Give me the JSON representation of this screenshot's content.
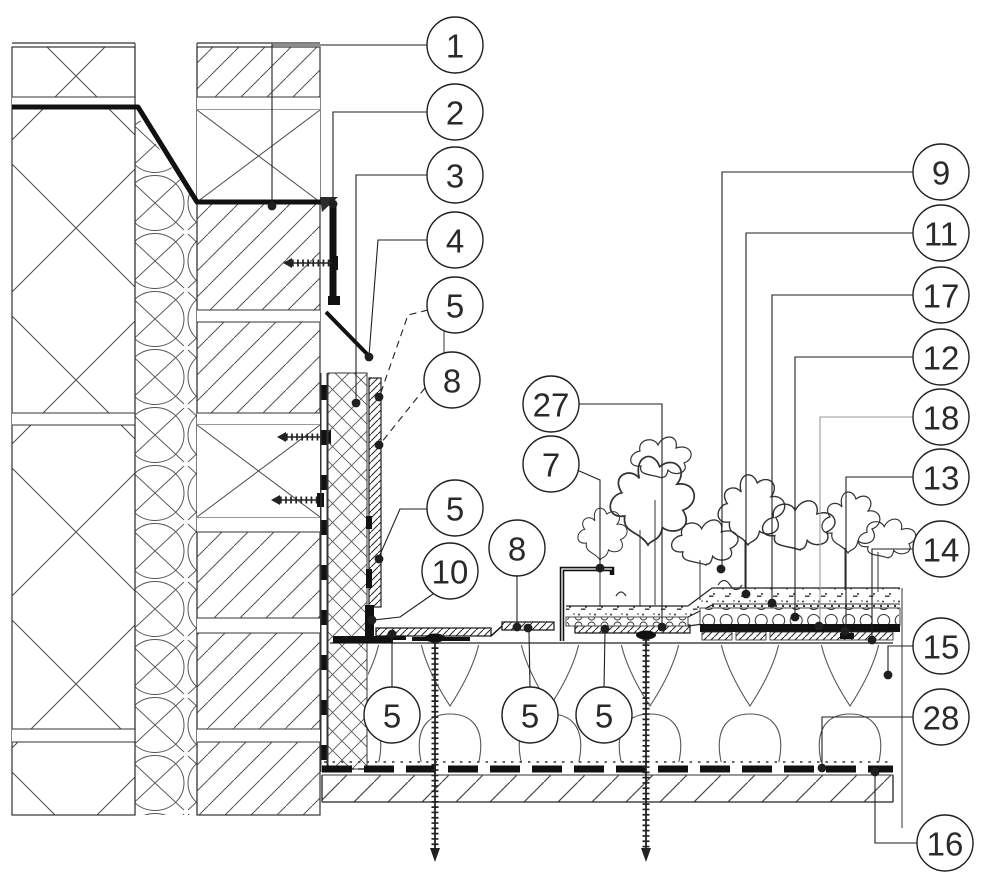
{
  "figure": {
    "type": "architectural-section-detail",
    "description": "Construction detail section: parapet wall junction with extensive green roof build-up, numbered component callouts",
    "colors": {
      "line": "#1f1f1f",
      "gray_leader": "#9a9a9a",
      "background": "#ffffff"
    },
    "callout_style": {
      "radius": 28,
      "font_size": 33,
      "dot_radius": 4.4
    },
    "callouts": [
      {
        "label": "1",
        "cx": 455,
        "cy": 45,
        "leader": [
          [
            427,
            45
          ],
          [
            272,
            45
          ],
          [
            272,
            206
          ]
        ],
        "dot": [
          272,
          206
        ]
      },
      {
        "label": "2",
        "cx": 455,
        "cy": 112,
        "leader": [
          [
            427,
            112
          ],
          [
            333,
            112
          ],
          [
            333,
            203
          ]
        ],
        "dot": [
          333,
          204
        ]
      },
      {
        "label": "3",
        "cx": 455,
        "cy": 175,
        "leader": [
          [
            427,
            175
          ],
          [
            356,
            175
          ],
          [
            356,
            402
          ]
        ],
        "dot": [
          356,
          403
        ]
      },
      {
        "label": "4",
        "cx": 455,
        "cy": 240,
        "leader": [
          [
            427,
            240
          ],
          [
            378,
            240
          ],
          [
            369,
            356
          ]
        ],
        "dot": [
          369,
          357
        ]
      },
      {
        "label": "5",
        "cx": 455,
        "cy": 305,
        "leader": [
          [
            428,
            310
          ],
          [
            408,
            315
          ],
          [
            380,
            395
          ]
        ],
        "dot": [
          379,
          397
        ],
        "dashed": true
      },
      {
        "label": "8",
        "cx": 452,
        "cy": 380,
        "leader": [
          [
            425,
            388
          ],
          [
            381,
            443
          ]
        ],
        "dot": [
          379,
          445
        ],
        "dashed": true
      },
      {
        "label": "5",
        "cx": 455,
        "cy": 508,
        "leader": [
          [
            429,
            509
          ],
          [
            400,
            509
          ],
          [
            379,
            557
          ]
        ],
        "dot": [
          379,
          559
        ]
      },
      {
        "label": "10",
        "cx": 450,
        "cy": 571,
        "leader": [
          [
            433,
            594
          ],
          [
            400,
            617
          ],
          [
            374,
            620
          ]
        ],
        "dot": [
          372,
          620
        ]
      },
      {
        "label": "8",
        "cx": 517,
        "cy": 548,
        "leader": [
          [
            517,
            576
          ],
          [
            517,
            625
          ]
        ],
        "dot": [
          517,
          627
        ]
      },
      {
        "label": "27",
        "cx": 551,
        "cy": 404,
        "leader": [
          [
            579,
            404
          ],
          [
            662,
            404
          ],
          [
            662,
            624
          ]
        ],
        "dot": [
          662,
          627
        ]
      },
      {
        "label": "7",
        "cx": 551,
        "cy": 464,
        "leader": [
          [
            577,
            470
          ],
          [
            600,
            480
          ],
          [
            600,
            566
          ]
        ],
        "dot": [
          600,
          568
        ]
      },
      {
        "label": "5",
        "cx": 392,
        "cy": 715,
        "leader": [
          [
            392,
            687
          ],
          [
            392,
            637
          ]
        ],
        "dot": [
          392,
          634
        ]
      },
      {
        "label": "5",
        "cx": 530,
        "cy": 715,
        "leader": [
          [
            530,
            687
          ],
          [
            529,
            631
          ]
        ],
        "dot": [
          528,
          628
        ]
      },
      {
        "label": "5",
        "cx": 604,
        "cy": 715,
        "leader": [
          [
            604,
            687
          ],
          [
            605,
            632
          ]
        ],
        "dot": [
          605,
          629
        ]
      },
      {
        "label": "9",
        "cx": 941,
        "cy": 172,
        "leader": [
          [
            913,
            172
          ],
          [
            722,
            172
          ],
          [
            722,
            567
          ]
        ],
        "dot": [
          721,
          569
        ]
      },
      {
        "label": "11",
        "cx": 941,
        "cy": 233,
        "leader": [
          [
            913,
            233
          ],
          [
            746,
            233
          ],
          [
            746,
            592
          ]
        ],
        "dot": [
          746,
          594
        ]
      },
      {
        "label": "17",
        "cx": 941,
        "cy": 295,
        "leader": [
          [
            913,
            295
          ],
          [
            772,
            295
          ],
          [
            772,
            601
          ]
        ],
        "dot": [
          772,
          603
        ]
      },
      {
        "label": "12",
        "cx": 941,
        "cy": 357,
        "leader": [
          [
            913,
            357
          ],
          [
            795,
            357
          ],
          [
            795,
            615
          ]
        ],
        "dot": [
          795,
          617
        ]
      },
      {
        "label": "18",
        "cx": 941,
        "cy": 417,
        "leader": [
          [
            913,
            417
          ],
          [
            820,
            417
          ],
          [
            820,
            624
          ]
        ],
        "dot": [
          819,
          626
        ],
        "gray": true
      },
      {
        "label": "13",
        "cx": 941,
        "cy": 477,
        "leader": [
          [
            913,
            477
          ],
          [
            846,
            477
          ],
          [
            846,
            629
          ]
        ],
        "dot": [
          845,
          631
        ]
      },
      {
        "label": "14",
        "cx": 941,
        "cy": 549,
        "leader": [
          [
            913,
            549
          ],
          [
            872,
            549
          ],
          [
            872,
            638
          ]
        ],
        "dot": [
          872,
          640
        ]
      },
      {
        "label": "15",
        "cx": 941,
        "cy": 646,
        "leader": [
          [
            913,
            646
          ],
          [
            888,
            646
          ],
          [
            888,
            673
          ]
        ],
        "dot": [
          888,
          675
        ]
      },
      {
        "label": "28",
        "cx": 941,
        "cy": 717,
        "leader": [
          [
            913,
            717
          ],
          [
            822,
            717
          ],
          [
            822,
            766
          ]
        ],
        "dot": [
          822,
          768
        ]
      },
      {
        "label": "16",
        "cx": 945,
        "cy": 843,
        "leader": [
          [
            917,
            843
          ],
          [
            875,
            843
          ],
          [
            875,
            774
          ]
        ],
        "dot": [
          875,
          772
        ]
      }
    ]
  }
}
